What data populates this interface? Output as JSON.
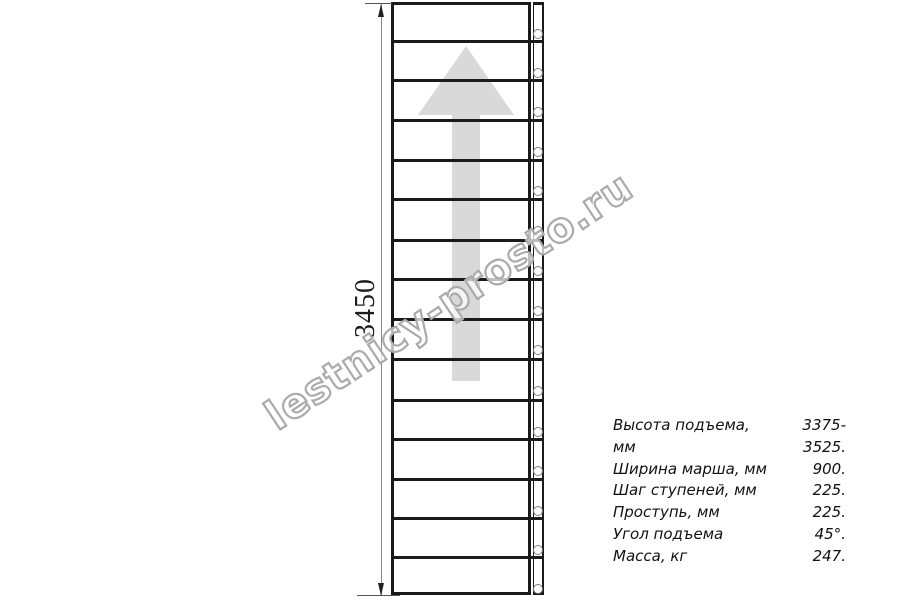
{
  "drawing": {
    "dimension_label": "3450",
    "watermark_text": "lestnicy-prosto.ru",
    "stair": {
      "treads_count": 15,
      "tread_line_ys": [
        41,
        80,
        120,
        160,
        199,
        240,
        279,
        319,
        359,
        400,
        439,
        479,
        518,
        557
      ],
      "hole_ys": [
        33,
        72,
        111,
        151,
        190,
        230,
        270,
        310,
        349,
        390,
        431,
        470,
        510,
        549,
        588
      ]
    },
    "colors": {
      "line": "#1a1a1a",
      "arrow_fill": "#d9d9d9",
      "watermark": "#ababab",
      "dimension_line": "#8a8a8a",
      "hole_stroke": "#7d7d7d"
    }
  },
  "specs": {
    "rows": [
      {
        "label": "Высота подъема, мм",
        "value": "3375-3525."
      },
      {
        "label": "Ширина марша, мм",
        "value": "900."
      },
      {
        "label": "Шаг ступеней, мм",
        "value": "225."
      },
      {
        "label": "Проступь, мм",
        "value": "225."
      },
      {
        "label": "Угол подъема",
        "value": "45°."
      },
      {
        "label": "Масса, кг",
        "value": "247."
      }
    ]
  }
}
